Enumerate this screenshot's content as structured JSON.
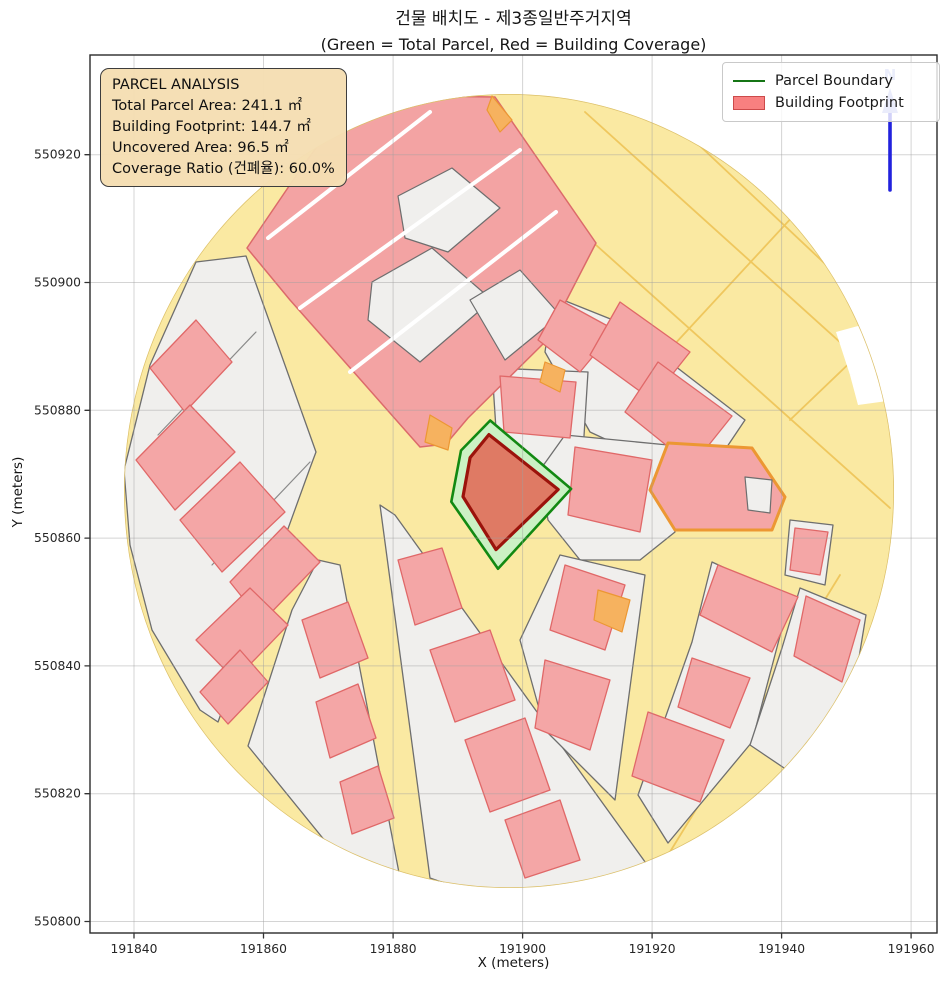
{
  "figure": {
    "title_line1": "건물 배치도 - 제3종일반주거지역",
    "title_line2": "(Green = Total Parcel, Red = Building Coverage)"
  },
  "axes": {
    "xlabel": "X (meters)",
    "ylabel": "Y (meters)",
    "xticks": [
      191840,
      191860,
      191880,
      191900,
      191920,
      191940,
      191960
    ],
    "yticks": [
      550800,
      550820,
      550840,
      550860,
      550880,
      550900,
      550920
    ],
    "xlim": [
      191833.2,
      191964.0
    ],
    "ylim": [
      550798.2,
      550935.6
    ],
    "grid": true
  },
  "info_box": {
    "title": "PARCEL ANALYSIS",
    "lines": [
      "Total Parcel Area: 241.1 ㎡",
      "Building Footprint: 144.7 ㎡",
      "Uncovered Area: 96.5 ㎡",
      "Coverage Ratio (건폐율): 60.0%"
    ]
  },
  "legend": {
    "items": [
      {
        "label": "Parcel Boundary",
        "type": "line",
        "color": "#157515"
      },
      {
        "label": "Building Footprint",
        "type": "patch",
        "fill": "#F88080",
        "edge": "#CC4A4A"
      }
    ]
  },
  "north_arrow": {
    "label": "N",
    "shaft_color": "#2222DD",
    "head_color": "#96A2E8"
  },
  "chart_data": {
    "type": "polygon-map",
    "title": "건물 배치도 - 제3종일반주거지역",
    "subtitle": "(Green = Total Parcel, Red = Building Coverage)",
    "total_parcel_area_m2": 241.1,
    "building_footprint_m2": 144.7,
    "uncovered_area_m2": 96.5,
    "coverage_ratio_pct": 60.0,
    "buffer_circle": {
      "center": [
        191897.9,
        550867.4
      ],
      "radius_m": 60
    },
    "parcel_boundary": {
      "stroke": "#128912",
      "fill": "#CBF1C4",
      "coords_m": [
        [
          191895.0,
          550878.4
        ],
        [
          191907.5,
          550867.7
        ],
        [
          191896.2,
          550855.2
        ],
        [
          191889.0,
          550865.7
        ],
        [
          191890.5,
          550873.7
        ]
      ]
    },
    "building_footprint": {
      "stroke": "#9B130B",
      "fill": "#DF7A64",
      "coords_m": [
        [
          191894.8,
          550876.2
        ],
        [
          191905.5,
          550867.6
        ],
        [
          191895.9,
          550858.2
        ],
        [
          191890.8,
          550866.5
        ],
        [
          191891.9,
          550872.6
        ]
      ]
    }
  },
  "context_map": {
    "units": "px",
    "ellipse": [
      509,
      491,
      385,
      397
    ],
    "colors": {
      "road_base": "#FAE9A2",
      "road_line": "#EFC75E",
      "edge": "#DCC06B",
      "block_fill": "#F0EFED",
      "block_stroke": "#6E6E6E",
      "building_fill": "#F4A6A6",
      "building_stroke": "#E06868",
      "mega_fill": "#F3A3A3",
      "mega_stroke": "#DC6A6A",
      "orange": "#EC9733",
      "orange_fill": "#F6B25F",
      "white": "#FFFFFF",
      "parcel_line": "#8A8A8A"
    },
    "road_lines": [
      [
        585,
        112,
        893,
        390
      ],
      [
        648,
        97,
        872,
        308
      ],
      [
        596,
        245,
        890,
        508
      ],
      [
        845,
        160,
        660,
        360
      ],
      [
        882,
        332,
        790,
        420
      ],
      [
        840,
        575,
        665,
        860
      ]
    ],
    "blocks": [
      [
        196,
        262,
        246,
        256,
        316,
        452,
        310,
        468,
        218,
        722,
        200,
        710,
        152,
        630,
        130,
        545,
        124,
        470,
        150,
        365
      ],
      [
        553,
        296,
        618,
        322,
        745,
        420,
        702,
        484,
        590,
        432,
        545,
        352
      ],
      [
        492,
        368,
        588,
        372,
        582,
        468,
        498,
        460
      ],
      [
        565,
        435,
        668,
        445,
        675,
        532,
        640,
        560,
        580,
        560,
        548,
        520,
        540,
        470
      ],
      [
        380,
        505,
        395,
        515,
        648,
        866,
        560,
        890,
        470,
        892,
        430,
        878
      ],
      [
        318,
        560,
        340,
        565,
        400,
        878,
        360,
        884,
        248,
        746,
        292,
        610
      ],
      [
        560,
        555,
        645,
        575,
        615,
        800,
        545,
        730,
        520,
        640
      ],
      [
        712,
        562,
        790,
        598,
        752,
        742,
        668,
        843,
        638,
        795,
        692,
        642
      ],
      [
        800,
        588,
        866,
        615,
        852,
        700,
        790,
        772,
        750,
        745,
        782,
        648
      ],
      [
        790,
        520,
        833,
        525,
        825,
        585,
        785,
        575
      ]
    ],
    "mega_block": [
      247,
      248,
      300,
      170,
      338,
      118,
      420,
      96,
      495,
      97,
      596,
      243,
      545,
      342,
      468,
      418,
      446,
      444,
      420,
      447,
      352,
      370,
      290,
      300
    ],
    "courts": [
      [
        398,
        196,
        452,
        168,
        500,
        208,
        448,
        252,
        405,
        238
      ],
      [
        372,
        282,
        432,
        248,
        492,
        300,
        420,
        362,
        368,
        320
      ],
      [
        470,
        300,
        520,
        270,
        560,
        315,
        505,
        360
      ]
    ],
    "white_lanes": [
      [
        300,
        308,
        520,
        150
      ],
      [
        268,
        238,
        430,
        112
      ],
      [
        350,
        372,
        556,
        212
      ]
    ],
    "parcel_lines": [
      [
        158,
        435,
        256,
        332
      ],
      [
        212,
        565,
        310,
        462
      ]
    ],
    "buildings": [
      [
        150,
        368,
        196,
        320,
        232,
        362,
        185,
        412
      ],
      [
        136,
        460,
        190,
        405,
        235,
        452,
        175,
        510
      ],
      [
        180,
        520,
        240,
        462,
        285,
        512,
        222,
        572
      ],
      [
        230,
        582,
        284,
        526,
        320,
        562,
        262,
        622
      ],
      [
        196,
        640,
        250,
        588,
        288,
        625,
        235,
        680
      ],
      [
        200,
        692,
        240,
        650,
        268,
        682,
        228,
        724
      ],
      [
        560,
        300,
        615,
        330,
        580,
        372,
        538,
        340
      ],
      [
        620,
        302,
        690,
        352,
        652,
        400,
        590,
        355
      ],
      [
        658,
        362,
        732,
        416,
        692,
        466,
        625,
        412
      ],
      [
        500,
        376,
        576,
        382,
        570,
        438,
        504,
        432
      ],
      [
        575,
        447,
        652,
        460,
        640,
        532,
        568,
        515
      ],
      [
        398,
        560,
        442,
        548,
        462,
        608,
        415,
        625
      ],
      [
        430,
        650,
        490,
        630,
        515,
        700,
        455,
        722
      ],
      [
        465,
        740,
        525,
        718,
        550,
        790,
        490,
        812
      ],
      [
        505,
        820,
        560,
        800,
        580,
        860,
        525,
        878
      ],
      [
        302,
        620,
        348,
        602,
        368,
        658,
        320,
        678
      ],
      [
        316,
        702,
        358,
        684,
        376,
        738,
        330,
        758
      ],
      [
        340,
        782,
        378,
        766,
        394,
        818,
        352,
        834
      ],
      [
        565,
        565,
        625,
        585,
        605,
        650,
        550,
        630
      ],
      [
        545,
        660,
        610,
        680,
        590,
        750,
        535,
        728
      ],
      [
        718,
        565,
        798,
        597,
        772,
        652,
        700,
        615
      ],
      [
        692,
        658,
        750,
        678,
        730,
        728,
        678,
        707
      ],
      [
        648,
        712,
        724,
        740,
        700,
        802,
        632,
        776
      ],
      [
        806,
        596,
        860,
        620,
        842,
        682,
        794,
        656
      ],
      [
        795,
        528,
        828,
        532,
        820,
        575,
        790,
        570
      ]
    ],
    "orange_accents": [
      [
        430,
        415,
        452,
        428,
        448,
        450,
        425,
        442
      ],
      [
        545,
        362,
        565,
        370,
        560,
        392,
        540,
        382
      ],
      [
        598,
        590,
        630,
        600,
        622,
        632,
        594,
        620
      ],
      [
        492,
        96,
        512,
        120,
        500,
        132,
        487,
        110
      ]
    ],
    "orange_parcel": {
      "outline": [
        668,
        443,
        752,
        448,
        785,
        497,
        772,
        530,
        675,
        530,
        650,
        490
      ],
      "inner": [
        745,
        477,
        772,
        480,
        770,
        513,
        748,
        510
      ]
    },
    "white_notches": [
      [
        836,
        332,
        880,
        320,
        890,
        365,
        850,
        375
      ],
      [
        850,
        375,
        890,
        362,
        895,
        400,
        858,
        405
      ]
    ]
  },
  "layout_px": {
    "plot_left": 90,
    "plot_top": 55,
    "plot_right": 937,
    "plot_bottom": 933,
    "north_arrow_x": 890,
    "north_arrow_top": 88,
    "north_arrow_bottom": 190
  }
}
